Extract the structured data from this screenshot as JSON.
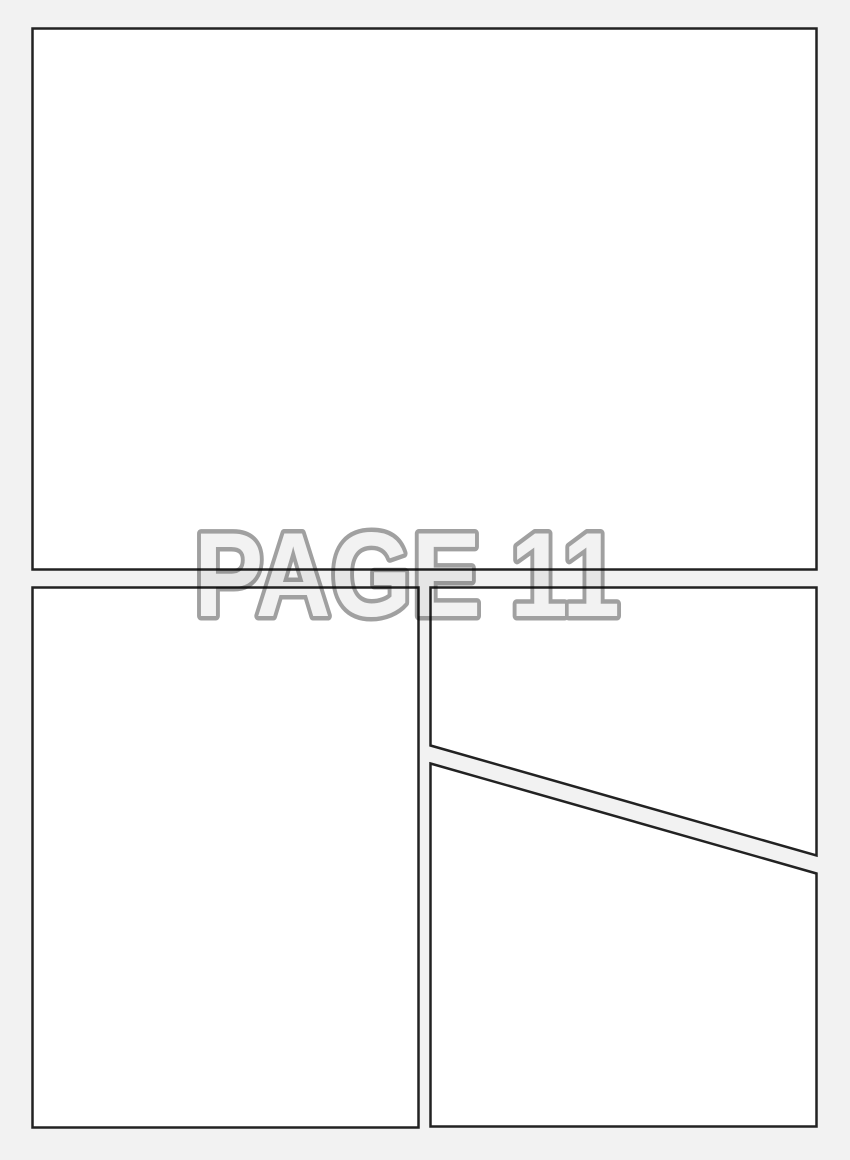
{
  "page": {
    "title": "PAGE 11"
  },
  "colors": {
    "background": "#f2f2f2",
    "panel_fill": "#ffffff",
    "panel_border": "#222222",
    "title_fill": "#f2f2f2",
    "title_outline": "#a0a0a0"
  },
  "panels": [
    {
      "id": "panel-top",
      "shape": "rectangle",
      "row": "top"
    },
    {
      "id": "panel-bottom-left",
      "shape": "rectangle",
      "row": "bottom"
    },
    {
      "id": "panel-top-right",
      "shape": "quad-diagonal-bottom-edge",
      "row": "bottom"
    },
    {
      "id": "panel-bottom-right",
      "shape": "quad-diagonal-top-edge",
      "row": "bottom"
    }
  ]
}
